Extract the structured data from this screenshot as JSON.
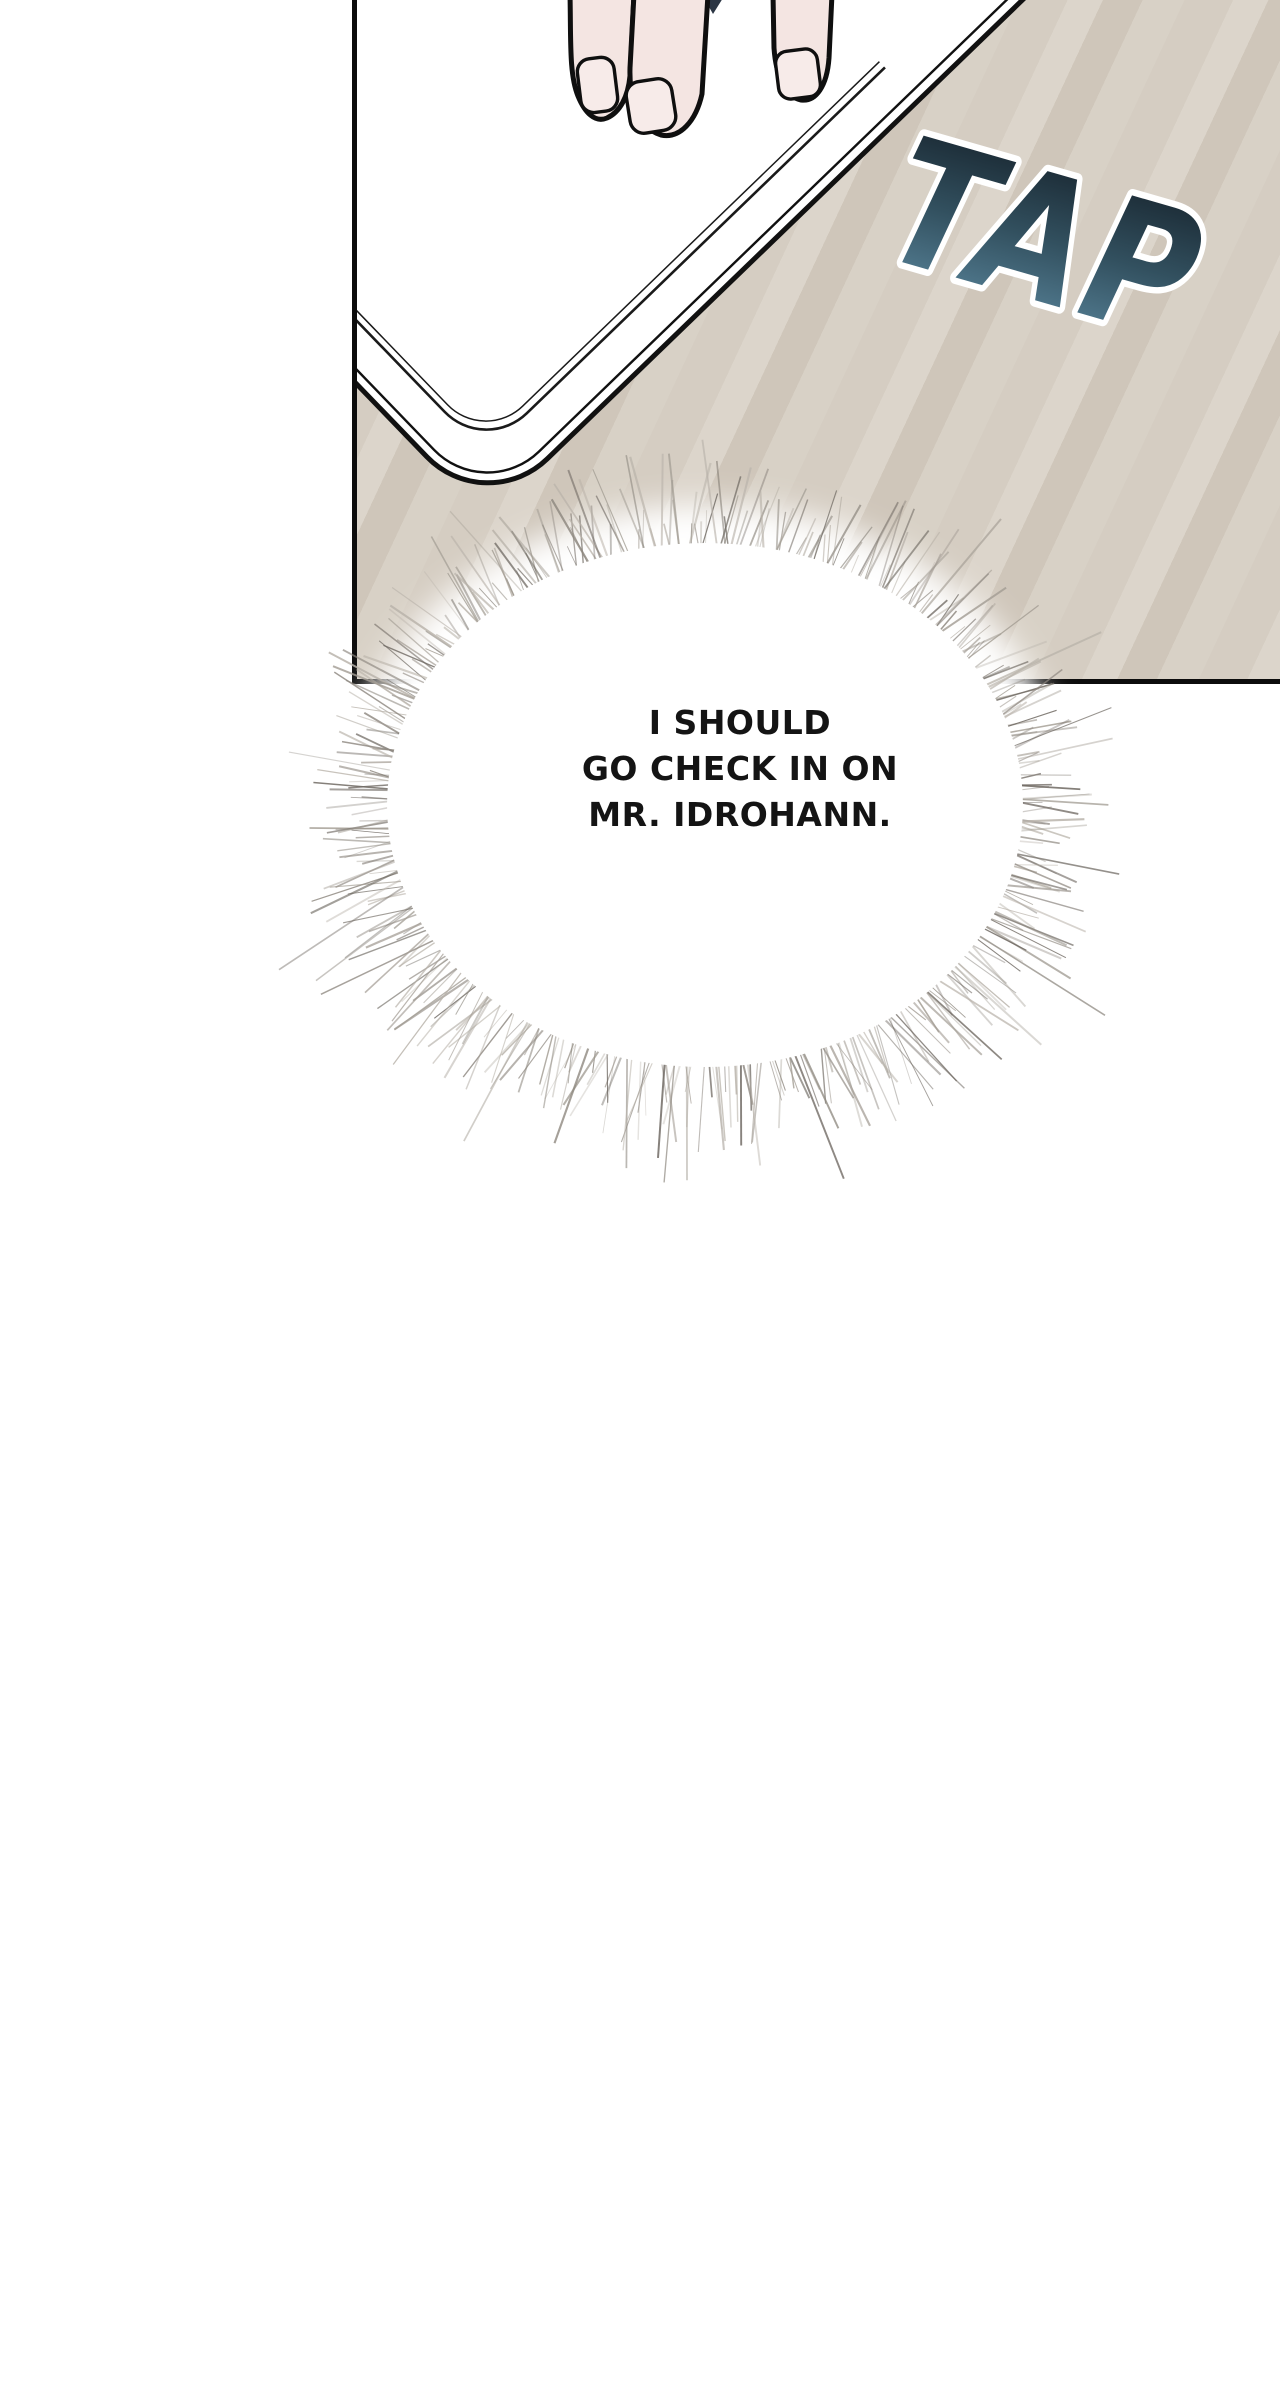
{
  "page": {
    "background_color": "#ffffff",
    "kind": "webtoon comic panel page"
  },
  "panel": {
    "border_color": "#0c0c0c",
    "desk": {
      "base_color": "#d5cdc2",
      "stripe_light": "#dcd5cb",
      "stripe_dark": "#cfc6ba"
    },
    "tablet": {
      "fill_color": "#ffffff",
      "outline_color": "#111111"
    },
    "hand": {
      "skin_color": "#f4e5e2",
      "nail_color": "#f7ebe9",
      "outline_color": "#0f0f0f",
      "shadow_gap_color": "#2c3644"
    }
  },
  "sfx_tap": {
    "text": "TAP",
    "gradient_top": "#141f28",
    "gradient_mid": "#32505f",
    "gradient_bottom": "#5d8aa1",
    "outline_color": "#ffffff"
  },
  "thought_bubble": {
    "lines": [
      "I SHOULD",
      "GO CHECK IN ON",
      "MR. IDROHANN."
    ],
    "text_color": "#141414",
    "fill_color": "#ffffff",
    "spike_colors": [
      "#8e8880",
      "#a39d94",
      "#b8b2a9",
      "#6e6861"
    ]
  }
}
